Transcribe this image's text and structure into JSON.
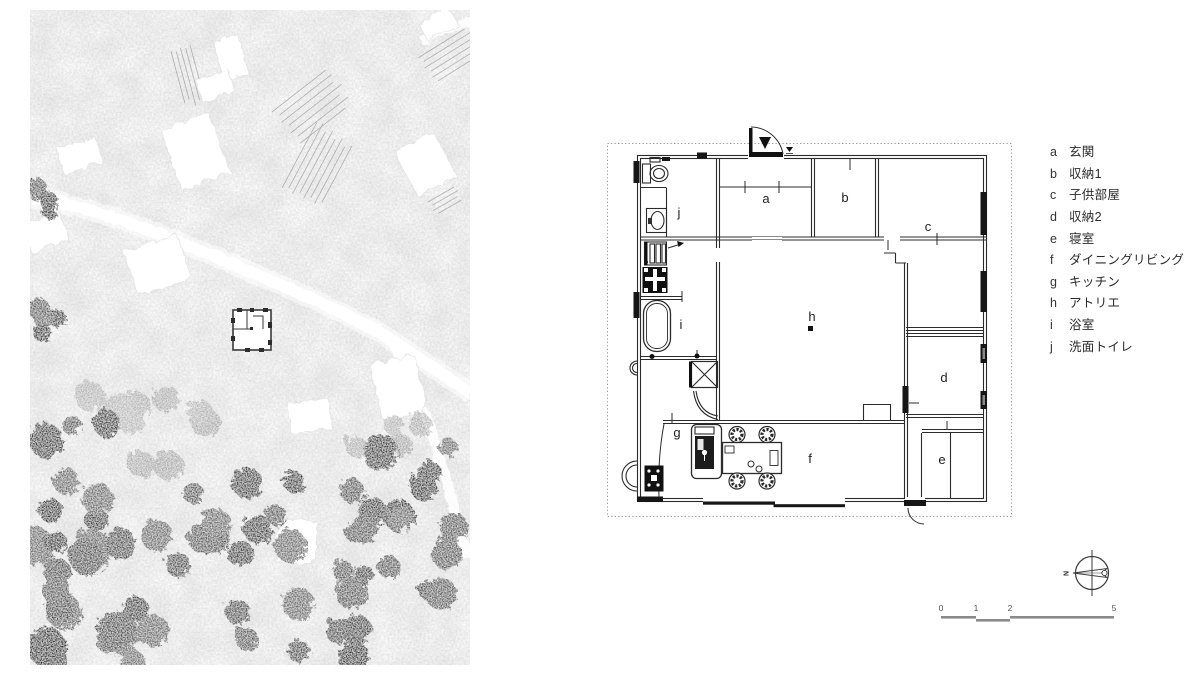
{
  "floor_plan": {
    "rooms": [
      {
        "id": "a",
        "label": "a"
      },
      {
        "id": "b",
        "label": "b"
      },
      {
        "id": "c",
        "label": "c"
      },
      {
        "id": "d",
        "label": "d"
      },
      {
        "id": "e",
        "label": "e"
      },
      {
        "id": "f",
        "label": "f"
      },
      {
        "id": "g",
        "label": "g"
      },
      {
        "id": "h",
        "label": "h"
      },
      {
        "id": "i",
        "label": "i"
      },
      {
        "id": "j",
        "label": "j"
      }
    ]
  },
  "legend": {
    "items": [
      {
        "letter": "a",
        "name": "玄関"
      },
      {
        "letter": "b",
        "name": "収納1"
      },
      {
        "letter": "c",
        "name": "子供部屋"
      },
      {
        "letter": "d",
        "name": "収納2"
      },
      {
        "letter": "e",
        "name": "寝室"
      },
      {
        "letter": "f",
        "name": "ダイニングリビング"
      },
      {
        "letter": "g",
        "name": "キッチン"
      },
      {
        "letter": "h",
        "name": "アトリエ"
      },
      {
        "letter": "i",
        "name": "浴室"
      },
      {
        "letter": "j",
        "name": "洗面トイレ"
      }
    ]
  },
  "compass": {
    "north_label": "N"
  },
  "scale_bar": {
    "labels": [
      "0",
      "1",
      "2",
      "5"
    ]
  },
  "colors": {
    "ink": "#2b2b2b",
    "window_fill": "#161616",
    "scale_gray": "#8a8a8a"
  }
}
